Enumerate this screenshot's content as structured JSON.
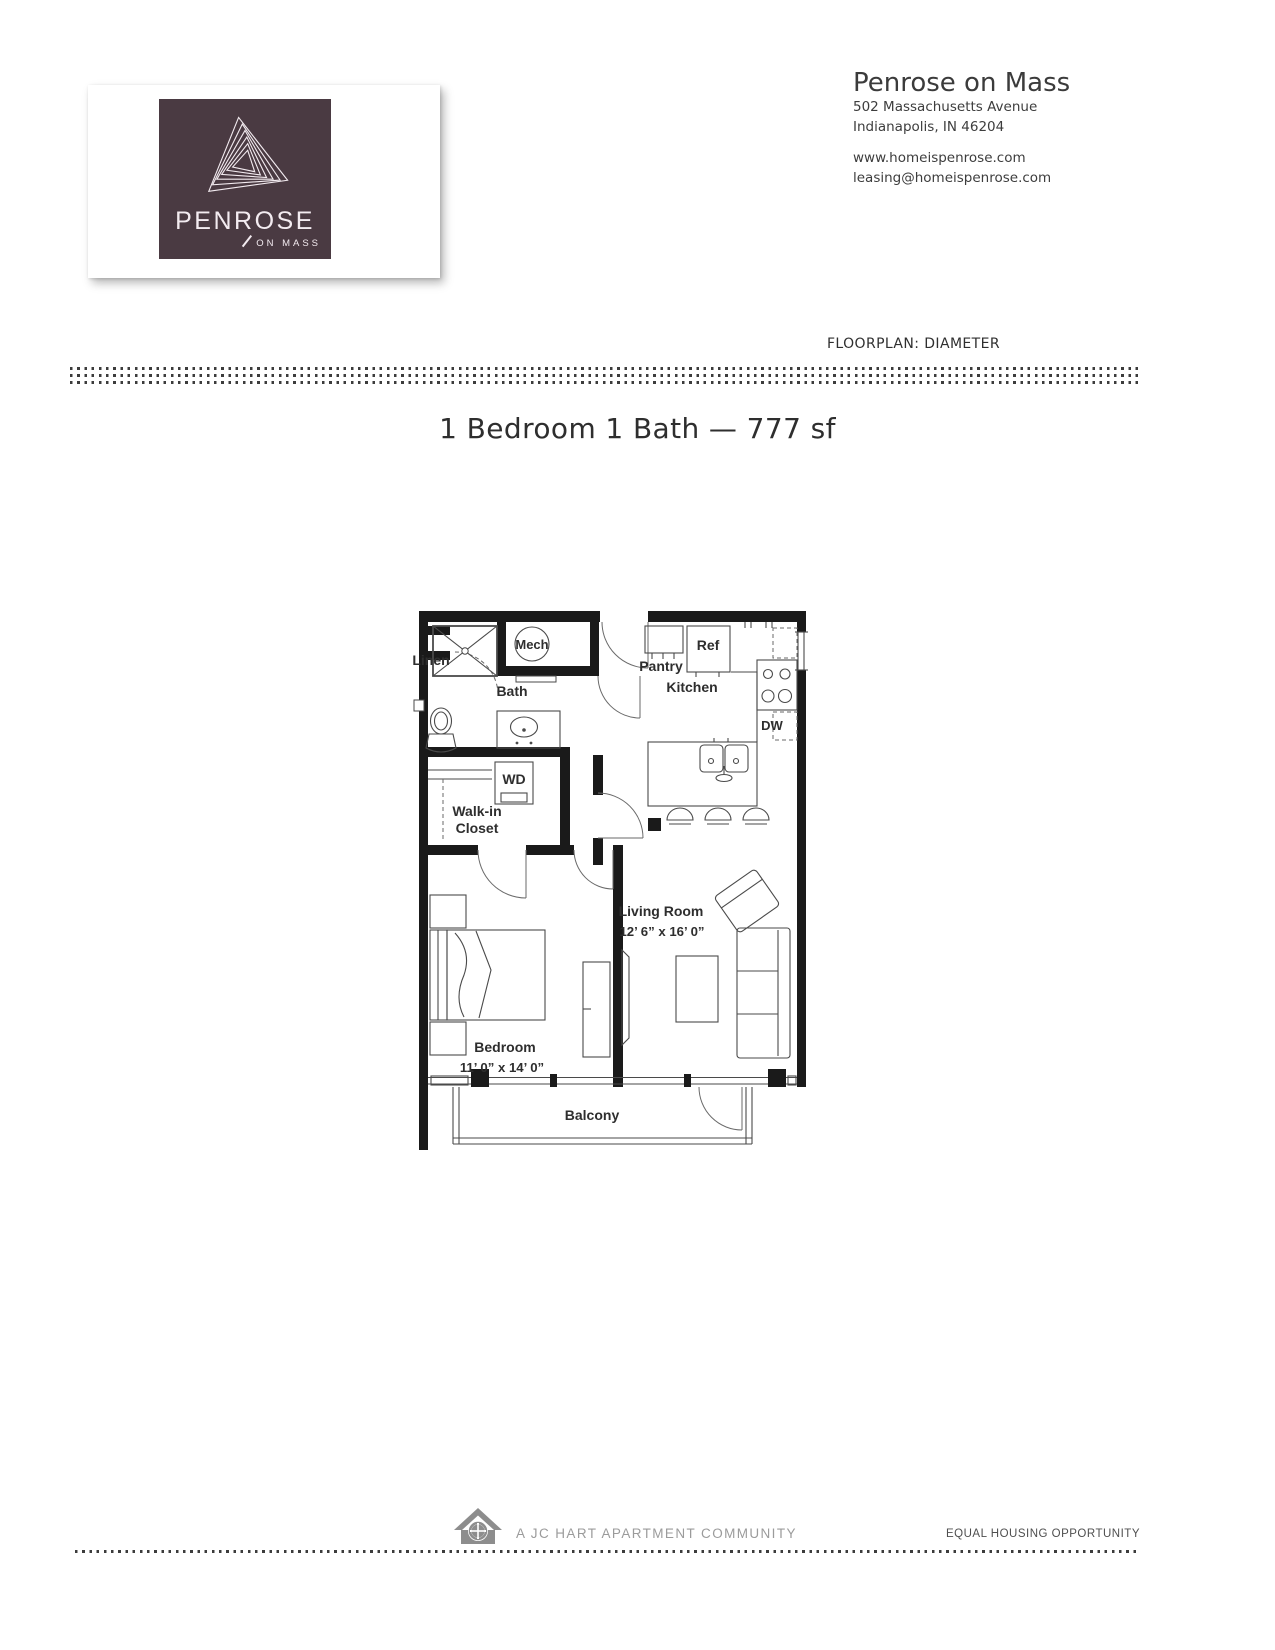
{
  "brand": {
    "logo_wordmark": "PENROSE",
    "logo_sub": "ON MASS",
    "color": "#4a3a42"
  },
  "header": {
    "title": "Penrose on Mass",
    "address1": "502 Massachusetts Avenue",
    "address2": "Indianapolis, IN 46204",
    "website": "www.homeispenrose.com",
    "email": "leasing@homeispenrose.com"
  },
  "floorplan_meta": {
    "label": "FLOORPLAN: DIAMETER",
    "title": "1 Bedroom 1 Bath — 777 sf"
  },
  "floorplan": {
    "labels": {
      "mech": "Mech",
      "linen": "Linen",
      "bath": "Bath",
      "pantry": "Pantry",
      "ref": "Ref",
      "kitchen": "Kitchen",
      "dw": "DW",
      "wd": "WD",
      "walkin1": "Walk-in",
      "walkin2": "Closet",
      "living": "Living Room",
      "living_dims": "12’ 6” x 16’ 0”",
      "bedroom": "Bedroom",
      "bedroom_dims": "11’ 0” x 14’ 0”",
      "balcony": "Balcony"
    }
  },
  "footer": {
    "community": "A JC HART APARTMENT COMMUNITY",
    "equal_housing": "EQUAL HOUSING OPPORTUNITY"
  }
}
